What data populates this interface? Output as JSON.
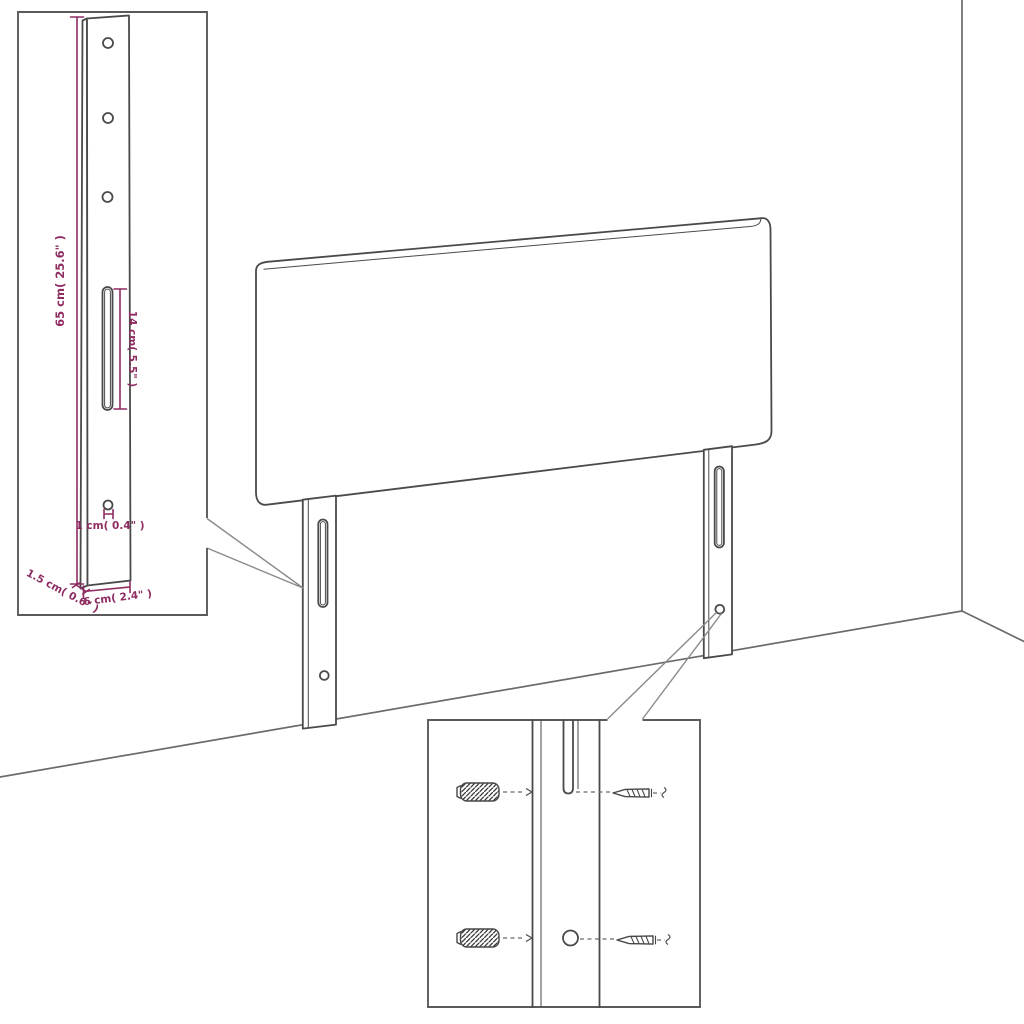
{
  "diagram": {
    "title": "headboard-assembly-dimension-diagram",
    "colors": {
      "dimension_accent": "#8e2c62",
      "line_art": "#4a4a4a",
      "room_lines": "#6b6b6b"
    },
    "dimensions": {
      "bracket_height": "65 cm( 25.6\" )",
      "slot_length": "14 cm( 5.5\" )",
      "hole_diameter": "1 cm( 0.4\" )",
      "bracket_depth": "1.5 cm( 0.6\" )",
      "bracket_width": "6 cm( 2.4\" )"
    }
  }
}
